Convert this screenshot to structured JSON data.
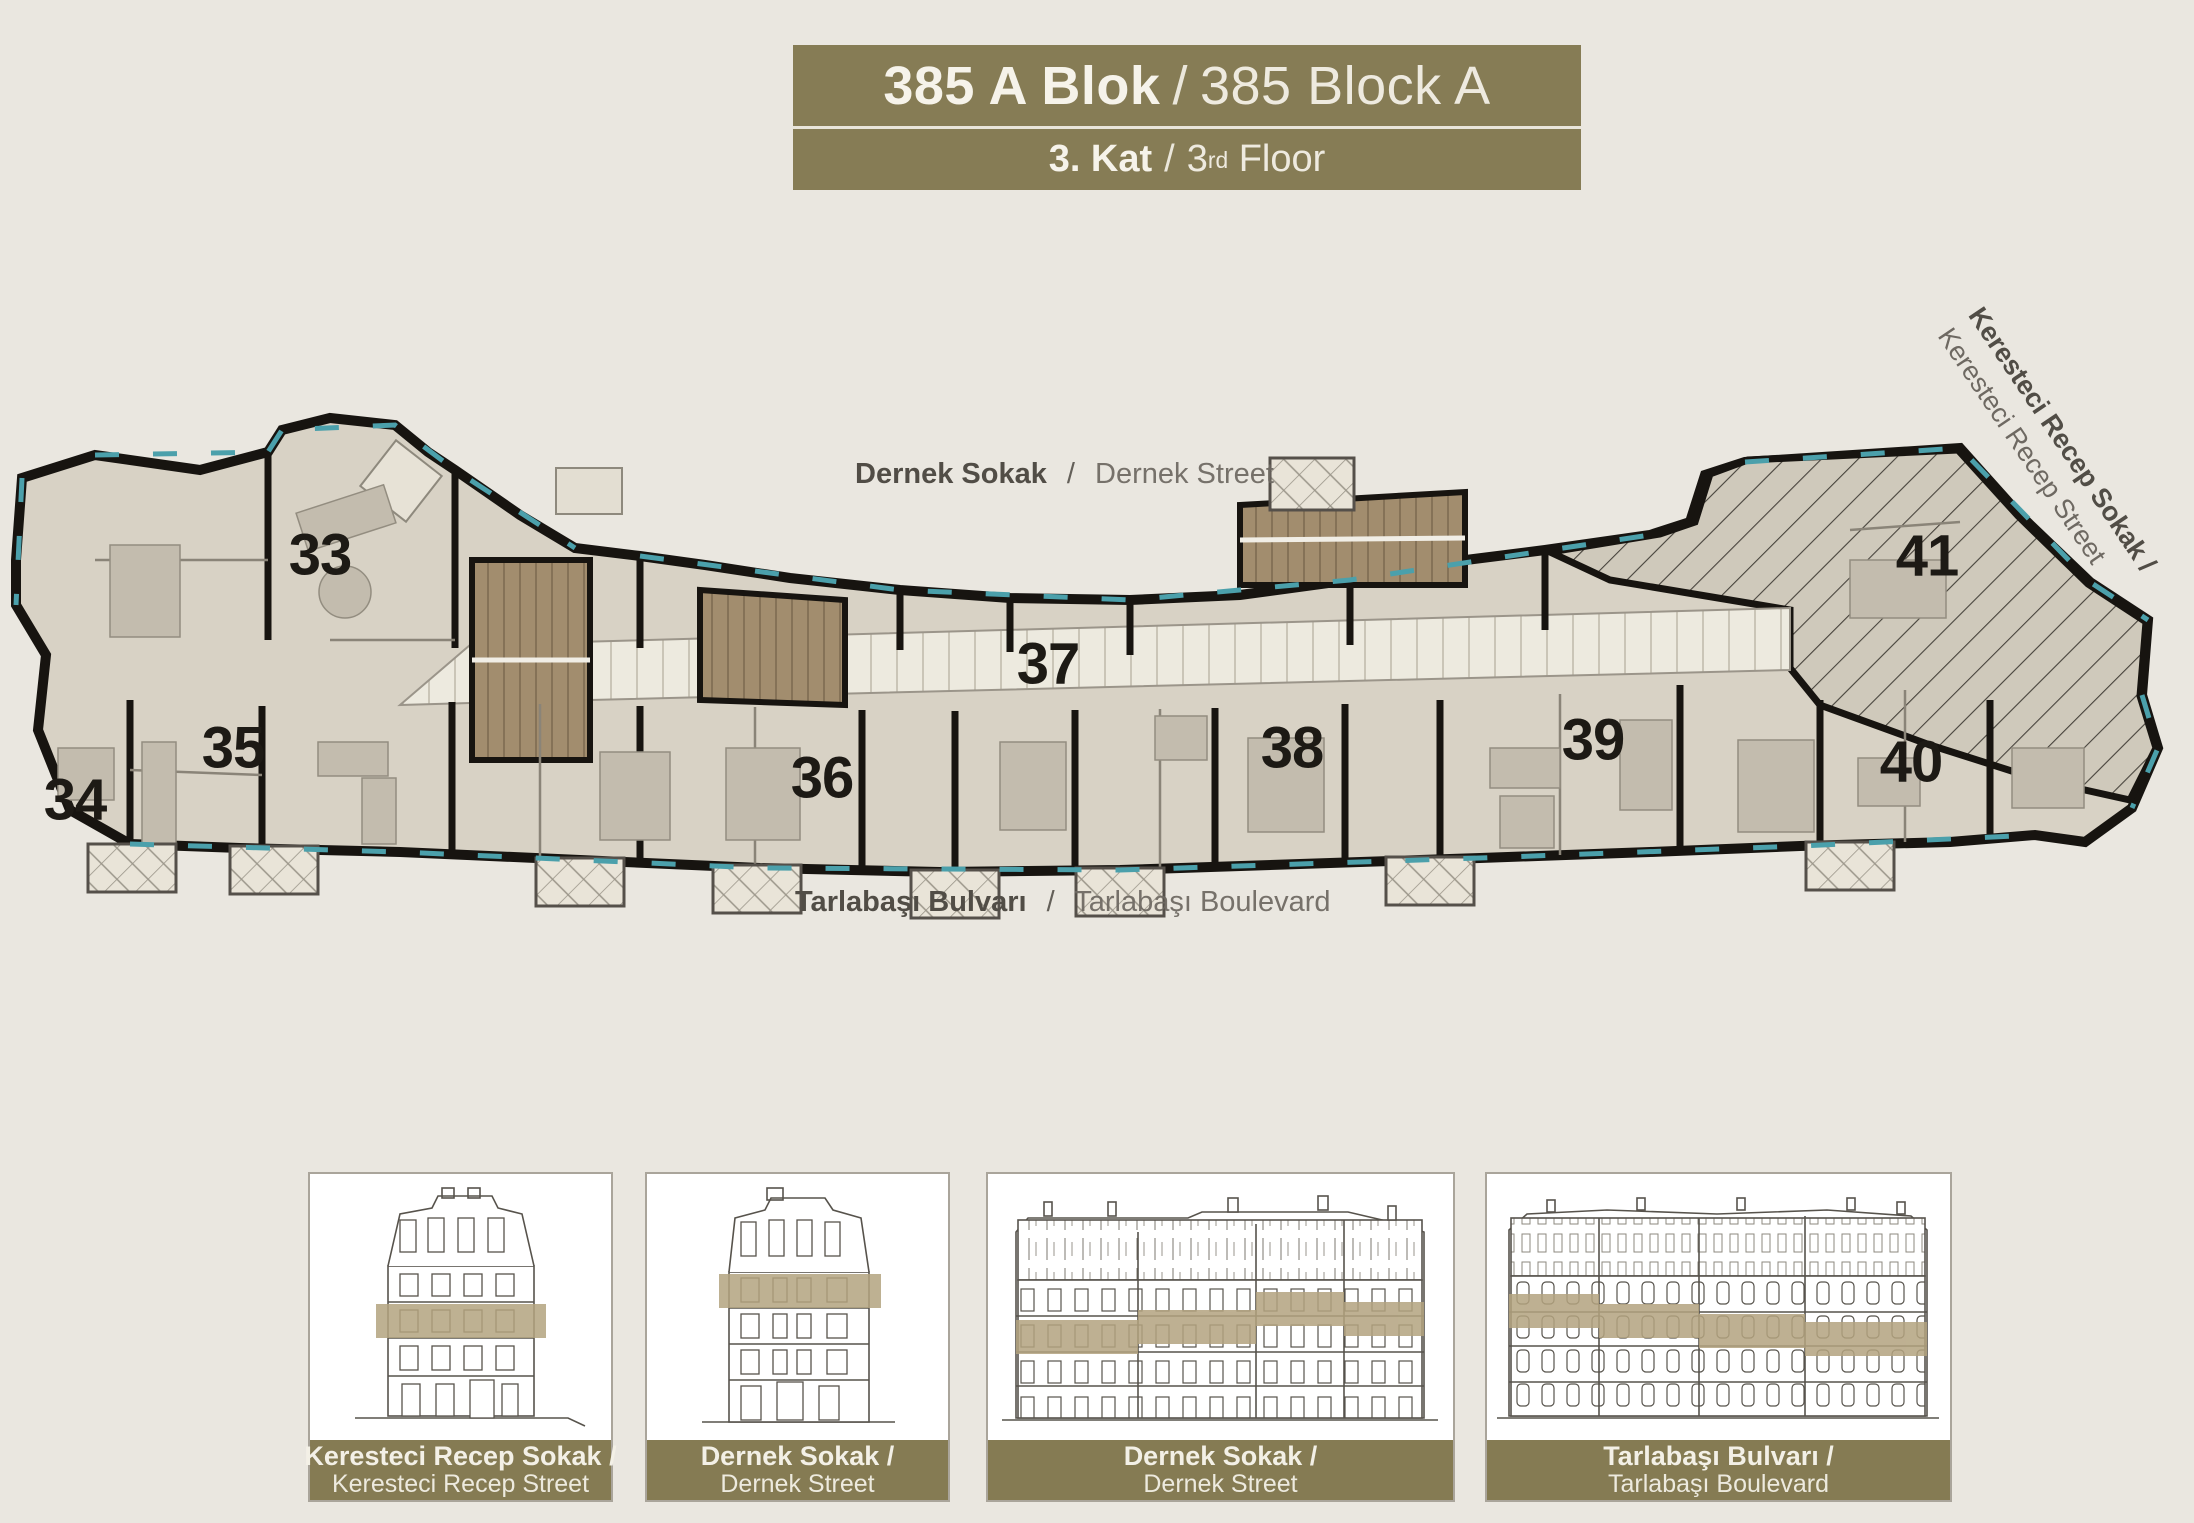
{
  "title": {
    "line1": {
      "bold": "385 A Blok",
      "separator": "/",
      "regular": "385 Block A"
    },
    "line2": {
      "bold": "3. Kat",
      "separator": "/",
      "number": "3",
      "superscript": "rd",
      "rest": " Floor"
    }
  },
  "streets": {
    "top": {
      "bold": "Dernek Sokak",
      "separator": "/",
      "regular": "Dernek Street"
    },
    "bottom": {
      "bold": "Tarlabaşı Bulvarı",
      "separator": "/",
      "regular": "Tarlabaşı Boulevard"
    },
    "diagonal": {
      "line1": "Keresteci Recep Sokak /",
      "line2": "Keresteci Recep Street"
    }
  },
  "plan": {
    "units": [
      {
        "number": "33"
      },
      {
        "number": "34"
      },
      {
        "number": "35"
      },
      {
        "number": "36"
      },
      {
        "number": "37"
      },
      {
        "number": "38"
      },
      {
        "number": "39"
      },
      {
        "number": "40"
      },
      {
        "number": "41"
      }
    ]
  },
  "elevations": {
    "cards": [
      {
        "caption_line1": "Keresteci Recep Sokak /",
        "caption_line2": "Keresteci Recep Street"
      },
      {
        "caption_line1": "Dernek Sokak /",
        "caption_line2": "Dernek Street"
      },
      {
        "caption_line1": "Dernek Sokak /",
        "caption_line2": "Dernek Street"
      },
      {
        "caption_line1": "Tarlabaşı Bulvarı /",
        "caption_line2": "Tarlabaşı Boulevard"
      }
    ]
  },
  "colors": {
    "background": "#eae7e0",
    "banner_olive": "#867c55",
    "caption_olive": "#857b53",
    "floor_highlight_band": "#b3a37f",
    "plan_room_fill": "#d8d2c5",
    "plan_wall": "#171410",
    "corridor_fill": "#edeadf",
    "stair_brown": "#a28d6e",
    "window_teal": "#4ba0ab",
    "street_text": "#56524b",
    "unit_number_text": "#1d1a15"
  }
}
